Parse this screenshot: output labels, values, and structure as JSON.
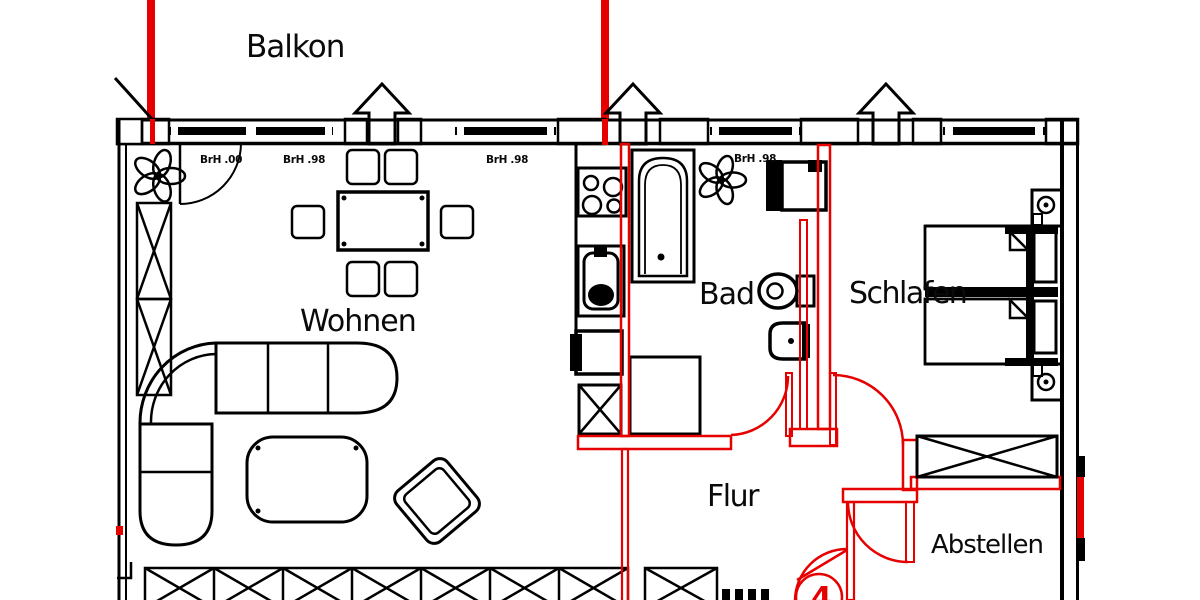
{
  "plan": {
    "balcony_label": "Balkon",
    "rooms": {
      "living": "Wohnen",
      "bath": "Bad",
      "bedroom": "Schlafen",
      "hall": "Flur",
      "storage": "Abstellen"
    },
    "window_annotations": [
      "BrH .00",
      "BrH .98",
      "BrH .98",
      "BrH .98"
    ],
    "apartment_number": "4",
    "colors": {
      "new_wall_red": "#e60000",
      "existing_wall_black": "#000000",
      "background": "#ffffff"
    }
  }
}
